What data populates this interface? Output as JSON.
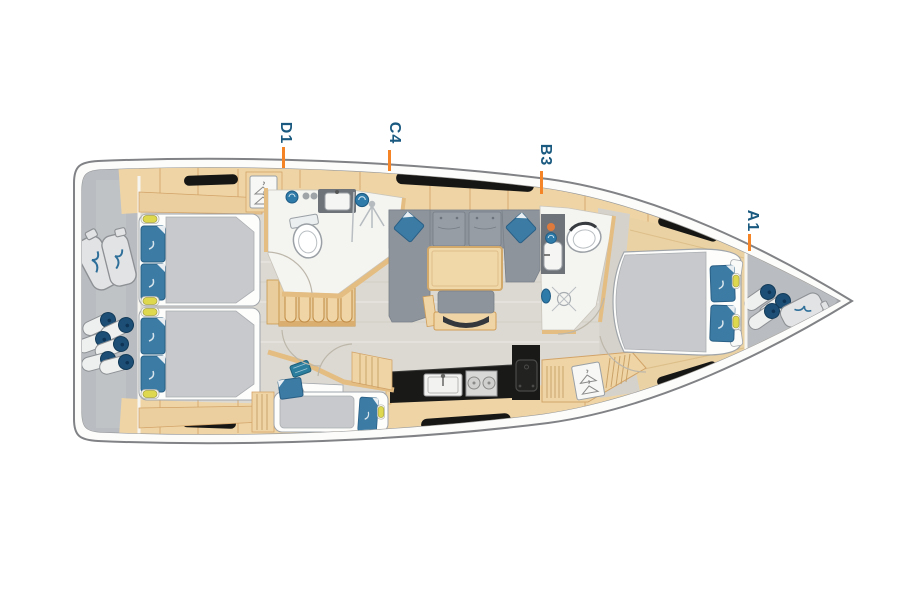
{
  "floorplan": {
    "type": "sailing-yacht-deck-plan",
    "orientation": "bow-right",
    "cabin_labels": [
      {
        "id": "d1",
        "label": "D1"
      },
      {
        "id": "c4",
        "label": "C4"
      },
      {
        "id": "b3",
        "label": "B3"
      },
      {
        "id": "a1",
        "label": "A1"
      }
    ],
    "features": [
      "transom storage with sail bags and fender stack",
      "port aft double cabin",
      "starboard aft double cabin",
      "companionway stairs",
      "forward wet head with toilet, sink and shower",
      "hanging wardrobe",
      "salon with U-shaped sofa, table and bench",
      "galley with sink, two-burner stove and oven",
      "aft single-berth cabin",
      "navigation lockers with hanging wardrobe",
      "second wet head with toilet, sink and shower",
      "bow double cabin",
      "bow storage with fenders and sail bag",
      "six hull windows"
    ],
    "colors": {
      "label_text": "#1b5a80",
      "label_tick": "#f58426",
      "hull_outline": "#808285",
      "deck_band": "#fcfcfa",
      "interior_floor": "#dcd9d2",
      "wood": "#efd5a6",
      "wood_edge": "#d2a368",
      "upholstery_gray": "#8e949c",
      "bedding_gray": "#c7c9cc",
      "mattress_white": "#fdfdfc",
      "pillow_blue": "#3b7ba4",
      "counter_black": "#191918",
      "window_black": "#161615",
      "stowage_gray": "#b9bcc0",
      "fender_navy": "#1d4f76",
      "lamp_yellow": "#ddd84e",
      "towel_blue": "#2e7aa8",
      "accent_orange": "#dd7a3c"
    }
  }
}
